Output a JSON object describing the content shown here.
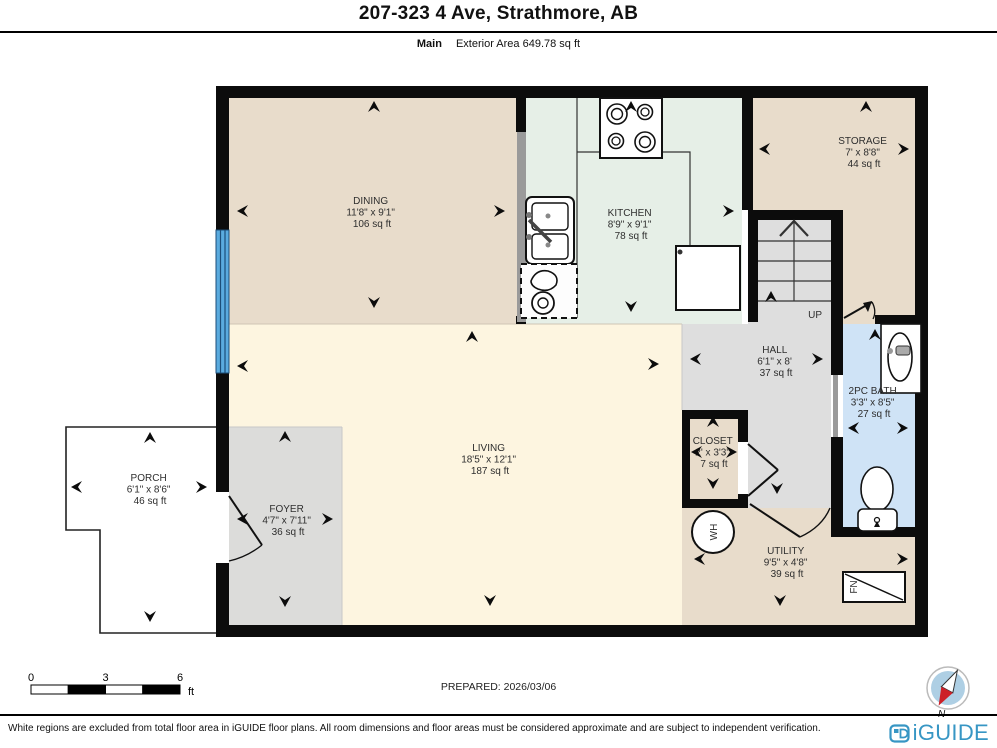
{
  "header": {
    "title": "207-323 4 Ave, Strathmore, AB",
    "floor_label": "Main",
    "area_label": "Exterior Area 649.78 sq ft"
  },
  "rooms": {
    "dining": {
      "name": "DINING",
      "dims": "11'8\" x 9'1\"",
      "area": "106 sq ft"
    },
    "kitchen": {
      "name": "KITCHEN",
      "dims": "8'9\" x 9'1\"",
      "area": "78 sq ft"
    },
    "storage": {
      "name": "STORAGE",
      "dims": "7' x 8'8\"",
      "area": "44 sq ft"
    },
    "hall": {
      "name": "HALL",
      "dims": "6'1\" x 8'",
      "area": "37 sq ft"
    },
    "bath": {
      "name": "2PC BATH",
      "dims": "3'3\" x 8'5\"",
      "area": "27 sq ft"
    },
    "closet": {
      "name": "CLOSET",
      "dims": "2' x 3'3\"",
      "area": "7 sq ft"
    },
    "living": {
      "name": "LIVING",
      "dims": "18'5\" x 12'1\"",
      "area": "187 sq ft"
    },
    "foyer": {
      "name": "FOYER",
      "dims": "4'7\" x 7'11\"",
      "area": "36 sq ft"
    },
    "porch": {
      "name": "PORCH",
      "dims": "6'1\" x 8'6\"",
      "area": "46 sq ft"
    },
    "utility": {
      "name": "UTILITY",
      "dims": "9'5\" x 4'8\"",
      "area": "39 sq ft"
    }
  },
  "annotations": {
    "up": "UP",
    "water_heater": "WH",
    "furnace": "FN",
    "compass_north": "N"
  },
  "scale_bar": {
    "tick0": "0",
    "tick1": "3",
    "tick2": "6",
    "unit": "ft"
  },
  "prepared": "PREPARED: 2026/03/06",
  "footer": {
    "disclaimer": "White regions are excluded from total floor area in iGUIDE floor plans. All room dimensions and floor areas must be considered approximate and are subject to independent verification.",
    "brand": "iGUIDE"
  },
  "colors": {
    "room_tan": "#e8dccb",
    "room_mint": "#e6efe7",
    "room_cream": "#fdf5e0",
    "room_gray": "#dedede",
    "room_blue": "#cfe3f6",
    "window_blue": "#5aabdf",
    "wall": "#0c0c0c",
    "brand_blue": "#3796c4",
    "compass_red": "#cc2027"
  }
}
